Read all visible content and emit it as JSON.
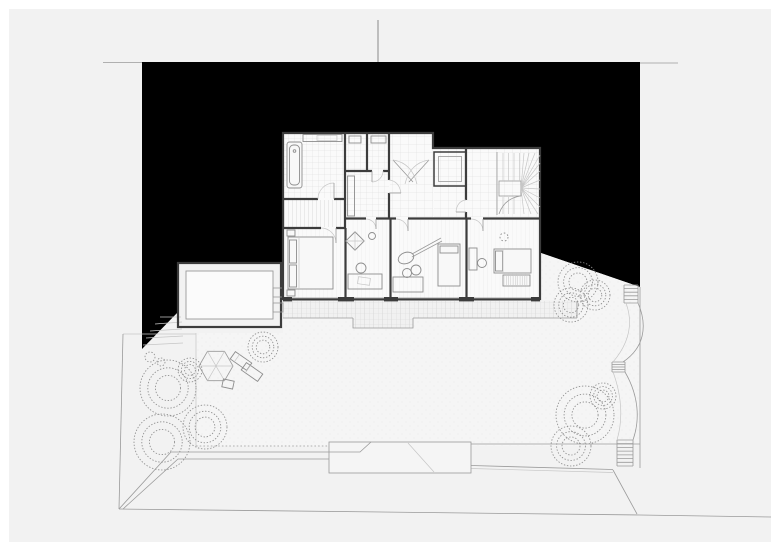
{
  "drawing": {
    "kind": "architectural-site-floor-plan",
    "visible_text": [],
    "colors": {
      "paper": "#ffffff",
      "field": "#f2f2f2",
      "ground": "#000000",
      "wall": "#3c3c3c",
      "line": "#9a9a9a",
      "faint": "#c6c6c6",
      "tile": "#dcdcdc",
      "room": "#fafafa",
      "pave": "#d9d9d9",
      "lawn": "#f5f5f5",
      "tree": "#8e8e8e",
      "furn": "#8d8d8d"
    },
    "rooms": [
      "bathroom",
      "dressing",
      "wc",
      "storage",
      "hall",
      "stairwell",
      "skylight-shaft",
      "bedroom-1",
      "bedroom-2",
      "bedroom-3",
      "bedroom-4",
      "garage-annex"
    ],
    "furniture": [
      "bathtub",
      "vanity",
      "double-bed",
      "single-bed",
      "desk",
      "chair",
      "guitar",
      "keyboard-piano",
      "side-table",
      "parasol",
      "sun-lounger",
      "plant"
    ],
    "site": [
      "figure-ground-mass",
      "terrace-paving",
      "lawn",
      "driveway-ramp",
      "retaining-walls",
      "property-boundary",
      "hillside-steps"
    ]
  },
  "scene": {
    "trees": [
      {
        "cx": 168,
        "cy": 388,
        "r": 28
      },
      {
        "cx": 190,
        "cy": 370,
        "r": 12
      },
      {
        "cx": 205,
        "cy": 427,
        "r": 22
      },
      {
        "cx": 162,
        "cy": 442,
        "r": 28
      },
      {
        "cx": 263,
        "cy": 347,
        "r": 15
      },
      {
        "cx": 578,
        "cy": 282,
        "r": 20
      },
      {
        "cx": 595,
        "cy": 295,
        "r": 15
      },
      {
        "cx": 571,
        "cy": 305,
        "r": 17
      },
      {
        "cx": 585,
        "cy": 415,
        "r": 29
      },
      {
        "cx": 571,
        "cy": 446,
        "r": 20
      },
      {
        "cx": 603,
        "cy": 396,
        "r": 13
      }
    ],
    "shrubs": [
      {
        "cx": 150,
        "cy": 357,
        "r": 5
      },
      {
        "cx": 161,
        "cy": 362,
        "r": 4
      }
    ],
    "step_flights": [
      {
        "x1": 624,
        "x2": 638,
        "y1": 285,
        "y2": 303,
        "treads": 5
      },
      {
        "x1": 612,
        "x2": 625,
        "y1": 362,
        "y2": 372,
        "treads": 4
      },
      {
        "x1": 617,
        "x2": 633,
        "y1": 440,
        "y2": 466,
        "treads": 7
      }
    ]
  }
}
